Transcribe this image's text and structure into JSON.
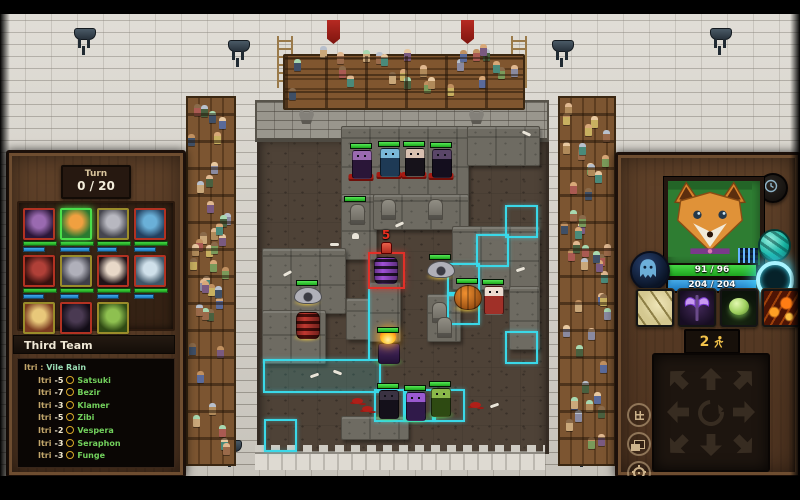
{
  "colors": {
    "accent_cyan": "#3ad8e8",
    "select_red": "#e23028",
    "hp_green": "#2ec82e",
    "mana_blue": "#2898e0",
    "gold": "#f2c24a"
  },
  "hud": {
    "turn": {
      "label": "Turn",
      "value": "0 / 20"
    },
    "roster": [
      {
        "id": "gremlin-purple",
        "border": "#b23222",
        "c1": "#9a6ab0",
        "c2": "#2a1638",
        "mp": 58,
        "active": false
      },
      {
        "id": "fox",
        "border": "#4ae04a",
        "c1": "#f0a040",
        "c2": "#2a7a30",
        "mp": 82,
        "active": true
      },
      {
        "id": "bat-gray",
        "border": "#9a8c2a",
        "c1": "#b8b8c0",
        "c2": "#45454e",
        "mp": 52,
        "active": false
      },
      {
        "id": "siren-blue",
        "border": "#b23222",
        "c1": "#6ab0d8",
        "c2": "#23405f",
        "mp": 60,
        "active": false
      },
      {
        "id": "demon-red",
        "border": "#b23222",
        "c1": "#b04038",
        "c2": "#38100e",
        "mp": 55,
        "active": false
      },
      {
        "id": "bat-gray-2",
        "border": "#9a8c2a",
        "c1": "#b0b0ba",
        "c2": "#3f3f49",
        "mp": 50,
        "active": false
      },
      {
        "id": "witch-pale",
        "border": "#b23222",
        "c1": "#e8d8c8",
        "c2": "#201418",
        "mp": 58,
        "active": false
      },
      {
        "id": "golem-ice",
        "border": "#b23222",
        "c1": "#cfe0ea",
        "c2": "#3f5668",
        "mp": 52,
        "active": false
      },
      {
        "id": "shroom",
        "border": "#9a8c2a",
        "c1": "#e8c87a",
        "c2": "#7a3a20",
        "mp": 60,
        "active": false
      },
      {
        "id": "shade-dark",
        "border": "#b23222",
        "c1": "#4a3a52",
        "c2": "#120c16",
        "mp": 48,
        "active": false
      },
      {
        "id": "orc-green",
        "border": "#9a8c2a",
        "c1": "#8ec050",
        "c2": "#2f4a14",
        "mp": 64,
        "active": false
      }
    ],
    "log": {
      "title": "Third Team",
      "cast_line": {
        "source": "Itri",
        "separator": ":",
        "spell": "Vile Rain"
      },
      "entries": [
        {
          "source": "Itri",
          "amount": "-5",
          "target": "Satsuki"
        },
        {
          "source": "Itri",
          "amount": "-7",
          "target": "Bezir"
        },
        {
          "source": "Itri",
          "amount": "-3",
          "target": "Klamer"
        },
        {
          "source": "Itri",
          "amount": "-5",
          "target": "Zibi"
        },
        {
          "source": "Itri",
          "amount": "-2",
          "target": "Vespera"
        },
        {
          "source": "Itri",
          "amount": "-3",
          "target": "Seraphon"
        },
        {
          "source": "Itri",
          "amount": "-3",
          "target": "Funge"
        }
      ]
    }
  },
  "right_panel": {
    "hp": "91 / 96",
    "mana": "204 / 204",
    "moves": {
      "value": "2",
      "icon": "runner-icon"
    },
    "icons": {
      "clock": "clock-icon",
      "spirit": "spirit-orb-icon",
      "sphere": "teal-sphere-icon",
      "ring": "glow-ring-icon",
      "abilities": [
        "claw-slash-icon",
        "purple-axe-icon",
        "green-orb-icon",
        "lava-hand-icon"
      ],
      "side": [
        "grid-icon",
        "layers-icon",
        "settings-gear-icon"
      ]
    }
  },
  "arena": {
    "damage_marker": "5",
    "units": [
      {
        "id": "gremlin-purple",
        "x": 361,
        "y": 150,
        "shape": "biped",
        "c": [
          "#9a6ab0",
          "#2a1638"
        ],
        "hp": 100,
        "base": "red"
      },
      {
        "id": "warrior-blue",
        "x": 389,
        "y": 148,
        "shape": "biped",
        "c": [
          "#7ab8d8",
          "#1e3a55"
        ],
        "hp": 100,
        "base": "red"
      },
      {
        "id": "witch-dark",
        "x": 414,
        "y": 148,
        "shape": "biped",
        "c": [
          "#d8c0b0",
          "#16121a"
        ],
        "hp": 100,
        "base": "red"
      },
      {
        "id": "panther-dark",
        "x": 441,
        "y": 149,
        "shape": "biped",
        "c": [
          "#5a4668",
          "#140e1e"
        ],
        "hp": 100,
        "base": "red"
      },
      {
        "id": "bat-left",
        "x": 307,
        "y": 287,
        "shape": "bat",
        "c": [
          "#b0b0b8",
          "#3c3c44"
        ],
        "hp": 100,
        "base": "yellowGlow"
      },
      {
        "id": "bat-right",
        "x": 440,
        "y": 261,
        "shape": "bat",
        "c": [
          "#b0b0b8",
          "#3c3c44"
        ],
        "hp": 100,
        "base": "yellowGlow"
      },
      {
        "id": "barrel-red",
        "x": 307,
        "y": 312,
        "shape": "barrel",
        "c": [
          "#c03830",
          "#4a0e0a"
        ],
        "hp": null,
        "base": "yellowGlow"
      },
      {
        "id": "barrel-purple",
        "x": 385,
        "y": 257,
        "shape": "barrel",
        "c": [
          "#a050d8",
          "#241430"
        ],
        "hp": null,
        "base": null
      },
      {
        "id": "pumpkin",
        "x": 467,
        "y": 285,
        "shape": "pumpkin",
        "c": [
          "#f09030",
          "#7a3808"
        ],
        "hp": 100,
        "base": "yellowGlow"
      },
      {
        "id": "shroom-white",
        "x": 493,
        "y": 286,
        "shape": "biped",
        "c": [
          "#ecdcd0",
          "#a03028"
        ],
        "hp": 100,
        "base": null
      },
      {
        "id": "fire-mage",
        "x": 388,
        "y": 334,
        "shape": "mage",
        "c": [
          "#ffd040",
          "#4a2a66"
        ],
        "hp": 100,
        "base": "greenGlow"
      },
      {
        "id": "assassin-dark",
        "x": 388,
        "y": 390,
        "shape": "biped",
        "c": [
          "#3a3242",
          "#14101a"
        ],
        "hp": 100,
        "base": "greenGlow"
      },
      {
        "id": "imp-violet",
        "x": 415,
        "y": 392,
        "shape": "biped",
        "c": [
          "#9a5ad0",
          "#301a4a"
        ],
        "hp": 100,
        "base": "greenGlow"
      },
      {
        "id": "orc-green",
        "x": 440,
        "y": 388,
        "shape": "biped",
        "c": [
          "#8ab84a",
          "#2e4a12"
        ],
        "hp": 100,
        "base": "greenGlow"
      }
    ],
    "stones": [
      [
        341,
        126,
        126,
        68
      ],
      [
        467,
        126,
        71,
        38
      ],
      [
        341,
        194,
        34,
        64
      ],
      [
        373,
        194,
        94,
        34
      ],
      [
        452,
        226,
        86,
        62
      ],
      [
        262,
        248,
        82,
        64
      ],
      [
        346,
        298,
        28,
        40
      ],
      [
        262,
        310,
        62,
        52
      ],
      [
        369,
        282,
        30,
        58
      ],
      [
        509,
        286,
        29,
        62
      ],
      [
        427,
        294,
        32,
        46
      ],
      [
        341,
        416,
        66,
        22
      ]
    ],
    "highlights": {
      "tiles": [
        [
          505,
          205
        ],
        [
          476,
          234
        ],
        [
          447,
          263
        ],
        [
          447,
          292
        ],
        [
          374,
          389
        ],
        [
          403,
          389
        ],
        [
          432,
          389
        ],
        [
          264,
          419
        ],
        [
          505,
          331
        ]
      ],
      "fills": [
        [
          263,
          359,
          114,
          30
        ]
      ],
      "lines": [
        [
          368,
          254,
          2,
          106
        ]
      ]
    },
    "decor": [
      [
        "grave",
        381,
        199
      ],
      [
        "grave",
        428,
        199
      ],
      [
        "grave",
        350,
        204
      ],
      [
        "grave",
        432,
        302
      ],
      [
        "grave",
        437,
        317
      ],
      [
        "bone",
        283,
        272
      ],
      [
        "bone",
        330,
        243
      ],
      [
        "bone",
        395,
        223
      ],
      [
        "bone",
        522,
        132
      ],
      [
        "bone",
        516,
        268
      ],
      [
        "bone",
        333,
        371
      ],
      [
        "bone",
        310,
        374
      ],
      [
        "bone",
        490,
        404
      ],
      [
        "skull",
        352,
        233
      ],
      [
        "splat",
        352,
        398
      ],
      [
        "splat",
        362,
        406
      ],
      [
        "splat",
        470,
        402
      ],
      [
        "hpbar",
        344,
        196
      ]
    ]
  }
}
